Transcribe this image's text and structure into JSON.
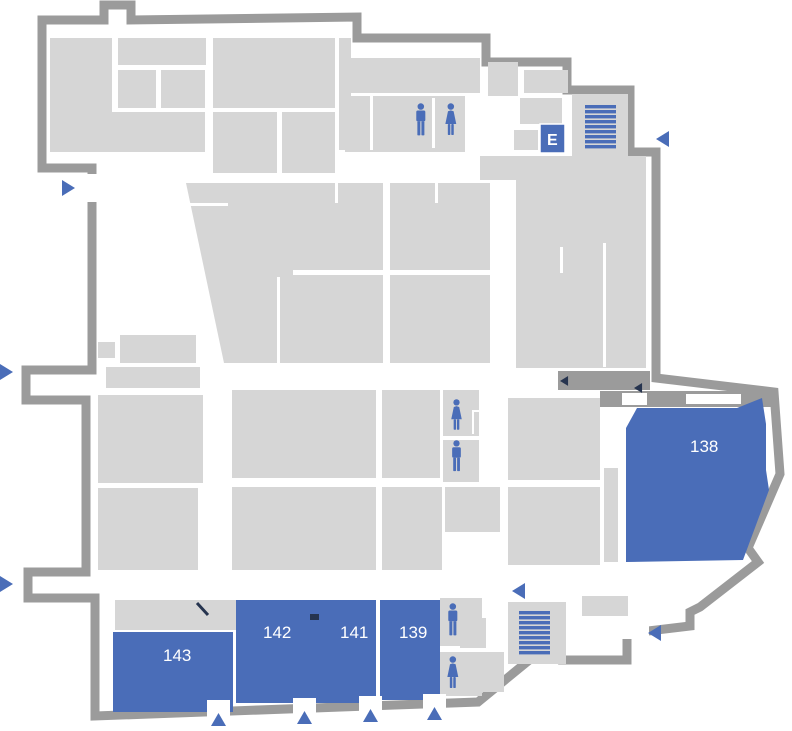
{
  "title": "Mall floor plan",
  "colors": {
    "accent_blue": "#4a6db8",
    "wall_gray": "#9b9b9b",
    "room_gray": "#d6d6d6",
    "dark_navy": "#26344f",
    "label_white": "#ffffff"
  },
  "rooms": [
    {
      "id": "138",
      "label": "138"
    },
    {
      "id": "139",
      "label": "139"
    },
    {
      "id": "141",
      "label": "141"
    },
    {
      "id": "142",
      "label": "142"
    },
    {
      "id": "143",
      "label": "143"
    }
  ],
  "elevator": {
    "label": "E"
  },
  "icons": {
    "restroom_male": "man-pictogram",
    "restroom_female": "woman-pictogram",
    "stairs": "striped-stairs",
    "entrance_arrow": "triangle-arrow",
    "door": "white-gap"
  }
}
